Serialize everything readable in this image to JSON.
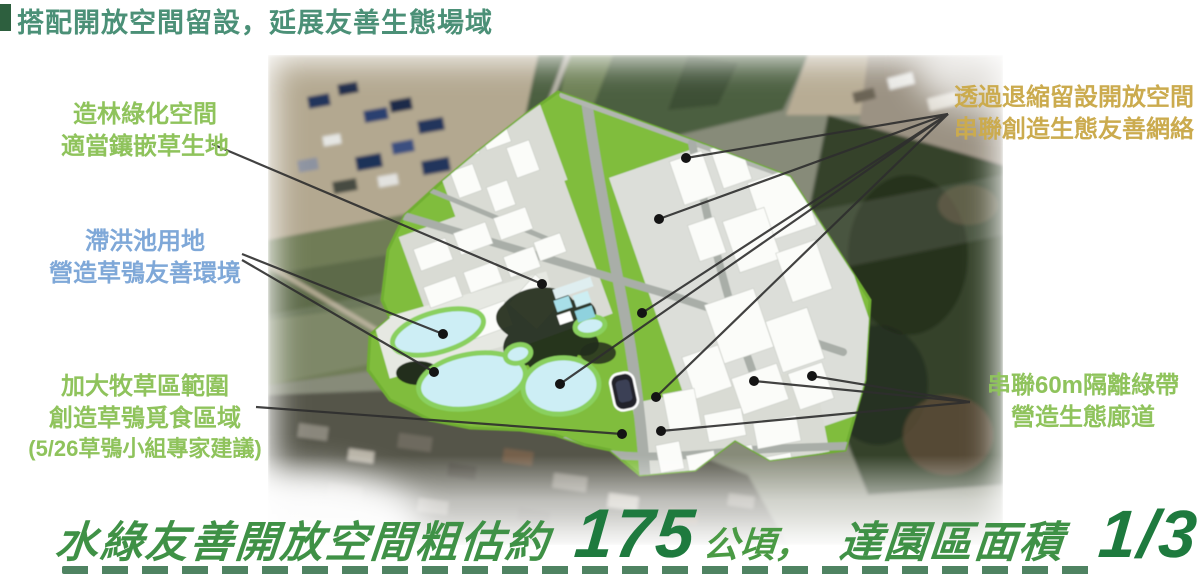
{
  "title": {
    "text": "搭配開放空間留設，延展友善生態場域"
  },
  "annotations": {
    "left": [
      {
        "id": "afforestation",
        "color": "#8fc35c",
        "lines": [
          "造林綠化空間",
          "適當鑲嵌草生地"
        ]
      },
      {
        "id": "detention-pond",
        "color": "#7fa8d8",
        "lines": [
          "滯洪池用地",
          "營造草鴞友善環境"
        ]
      },
      {
        "id": "pasture-area",
        "color": "#8fc35c",
        "lines": [
          "加大牧草區範圍",
          "創造草鴞覓食區域",
          "(5/26草鴞小組專家建議)"
        ]
      }
    ],
    "right": [
      {
        "id": "setback-open-space",
        "color": "#cbab4e",
        "lines": [
          "透過退縮留設開放空間",
          "串聯創造生態友善網絡"
        ]
      },
      {
        "id": "isolation-greenbelt",
        "color": "#8fc35c",
        "lines": [
          "串聯60m隔離綠帶",
          "營造生態廊道"
        ]
      }
    ]
  },
  "banner": {
    "prefix": "水綠友善開放空間粗估約",
    "area_value": "175",
    "area_unit": "公頃，",
    "middle": "達園區面積",
    "fraction": "1/3"
  },
  "colors": {
    "title_green": "#4b9077",
    "annotation_green": "#8fc35c",
    "annotation_blue": "#7fa8d8",
    "annotation_gold": "#cbab4e",
    "banner_green": "#3f9146",
    "banner_dark_green": "#1e7a3e",
    "plan_green": "#80bd3c",
    "pond_blue": "#cdeef5"
  }
}
